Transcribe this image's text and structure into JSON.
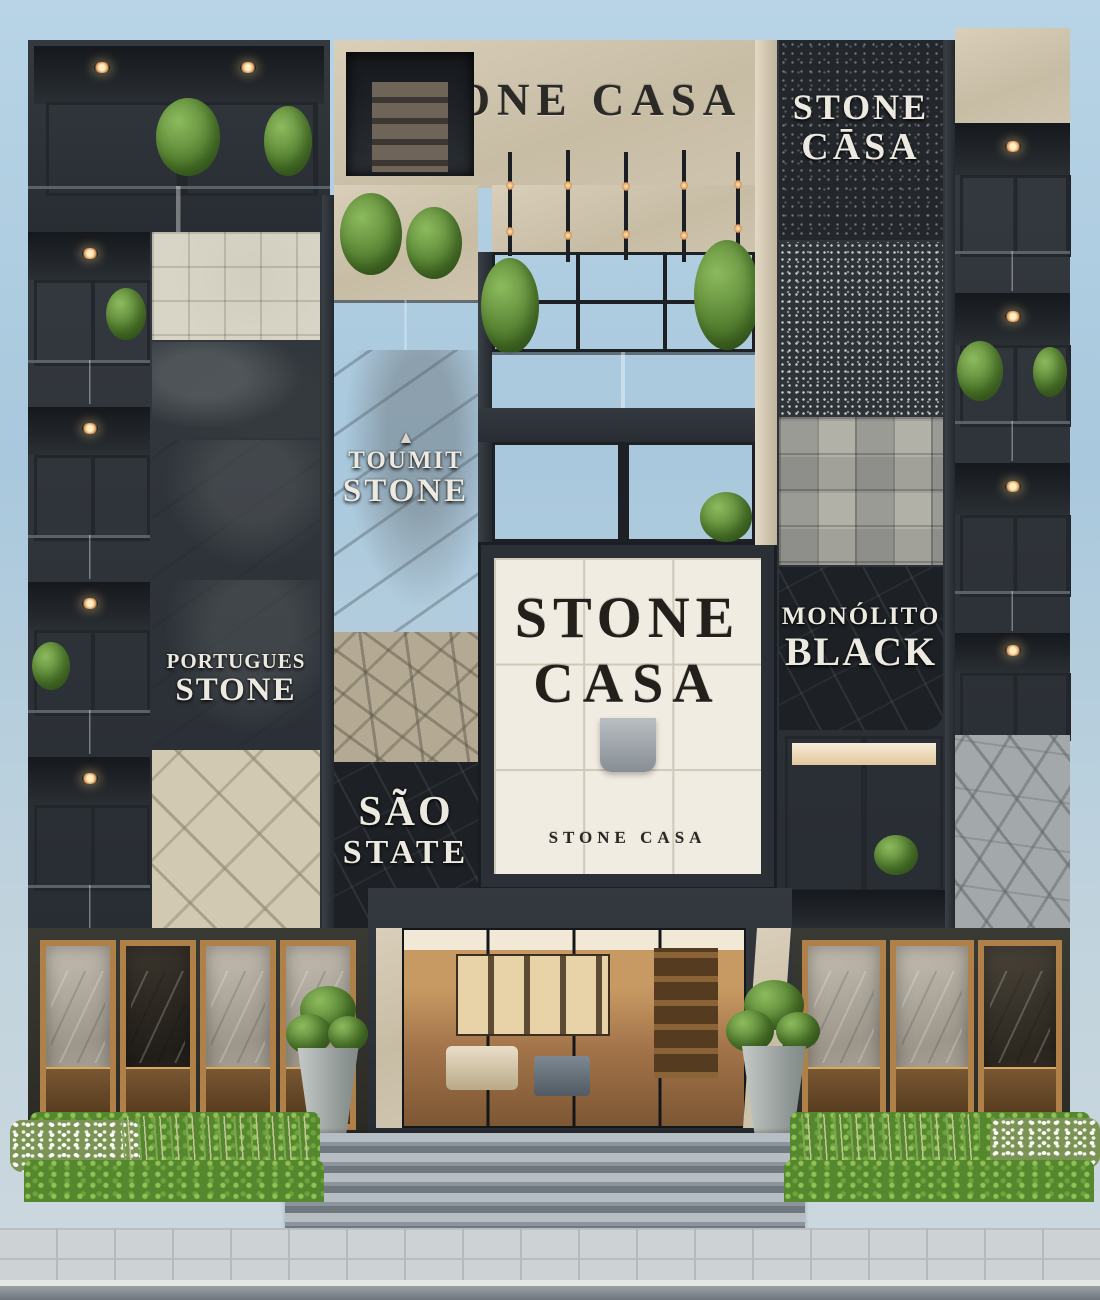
{
  "scene": {
    "description": "Stone Casa stone-showroom building facade with stacked stone sample panels, balconies, entrance showroom and street garden"
  },
  "signs": {
    "main_title": "STONE CASA",
    "right_top": {
      "line1": "STONE",
      "line2": "CĀSA"
    },
    "toumit": {
      "icon": "▲",
      "line1": "TOUMIT",
      "line2": "STONE"
    },
    "portugues": {
      "line1": "PORTUGUES",
      "line2": "STONE"
    },
    "sao": {
      "line1": "SÃO",
      "line2": "STATE"
    },
    "monolito": {
      "line1": "MONÓLITO",
      "line2": "BLACK"
    },
    "showcase": {
      "line1": "STONE",
      "line2": "CASA"
    },
    "showcase_small": "STONE CASA"
  },
  "colors": {
    "sky": "#a9c8dd",
    "charcoal_frame": "#31363c",
    "beige_stone": "#cec3ad",
    "black_stone": "#1d2125",
    "warm_window": "#dcab77",
    "greenery": "#5f8a3c",
    "wood_frame": "#b08049",
    "glass_railing": "#b9c9cf",
    "showcase_glass": "#f1ece1"
  }
}
